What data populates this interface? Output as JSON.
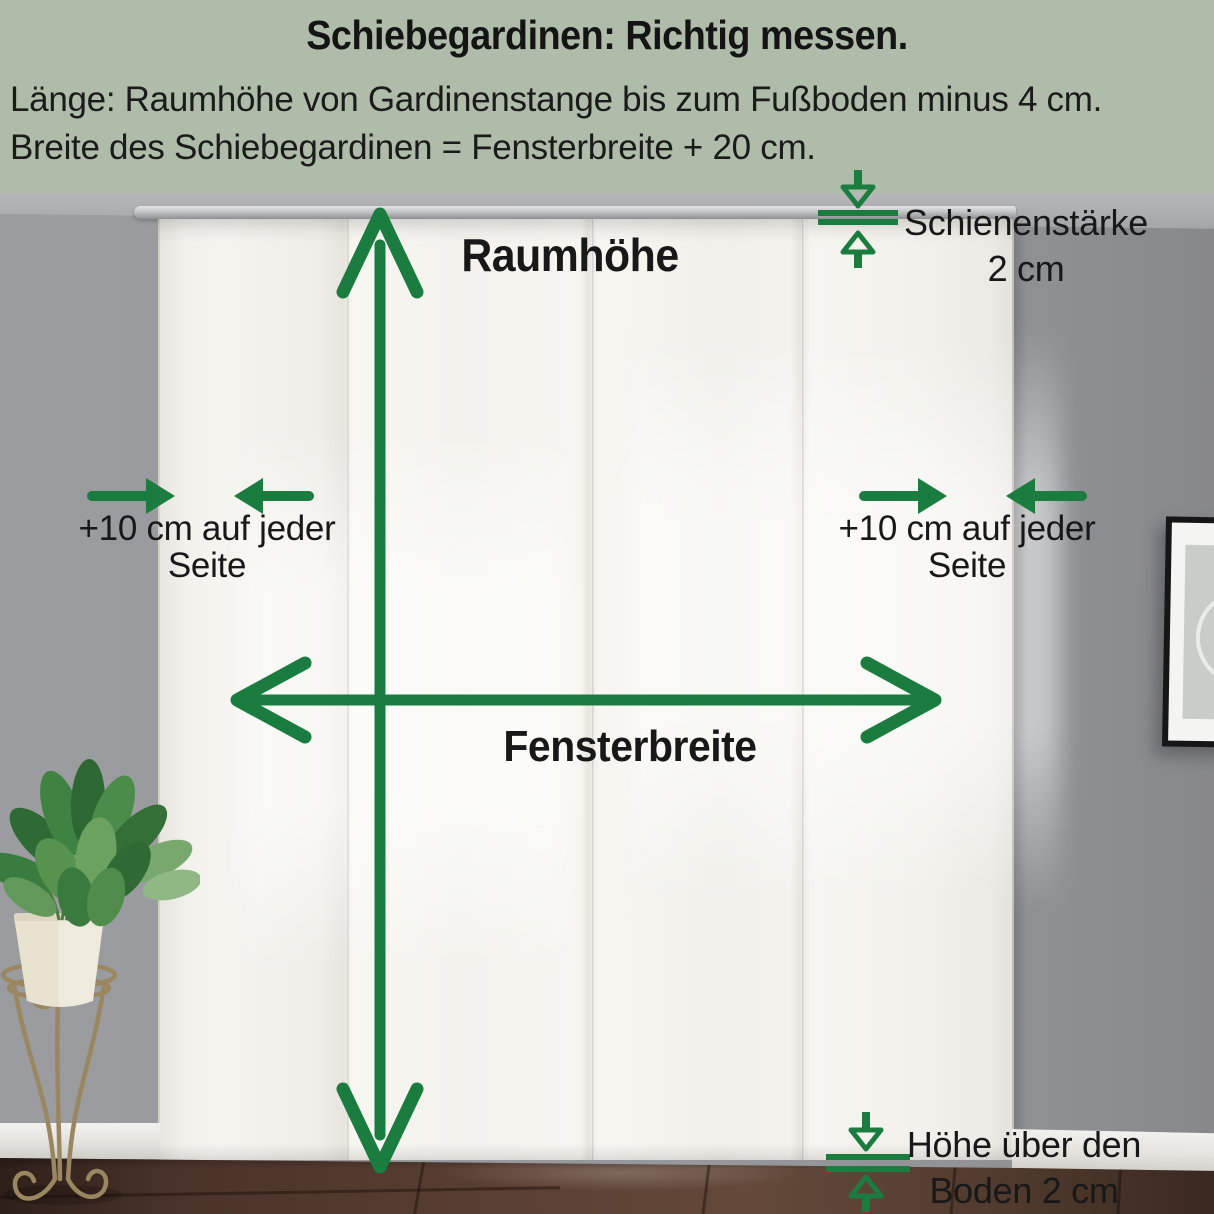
{
  "title": "Schiebegardinen: Richtig messen.",
  "subtitle_line1": "Länge: Raumhöhe von Gardinenstange bis zum Fußboden minus 4 cm.",
  "subtitle_line2": "Breite des Schiebegardinen = Fensterbreite + 20 cm.",
  "labels": {
    "room_height": "Raumhöhe",
    "window_width": "Fensterbreite",
    "left_margin_line1": "+10 cm auf jeder",
    "left_margin_line2": "Seite",
    "right_margin_line1": "+10 cm auf jeder",
    "right_margin_line2": "Seite",
    "rail_line1": "Schienenstärke",
    "rail_line2": "2 cm",
    "floor_line1": "Höhe über den",
    "floor_line2": "Boden 2 cm"
  },
  "colors": {
    "accent_green": "#1B7C40",
    "header_background": "#AFBCA9",
    "text_black": "#141414"
  }
}
